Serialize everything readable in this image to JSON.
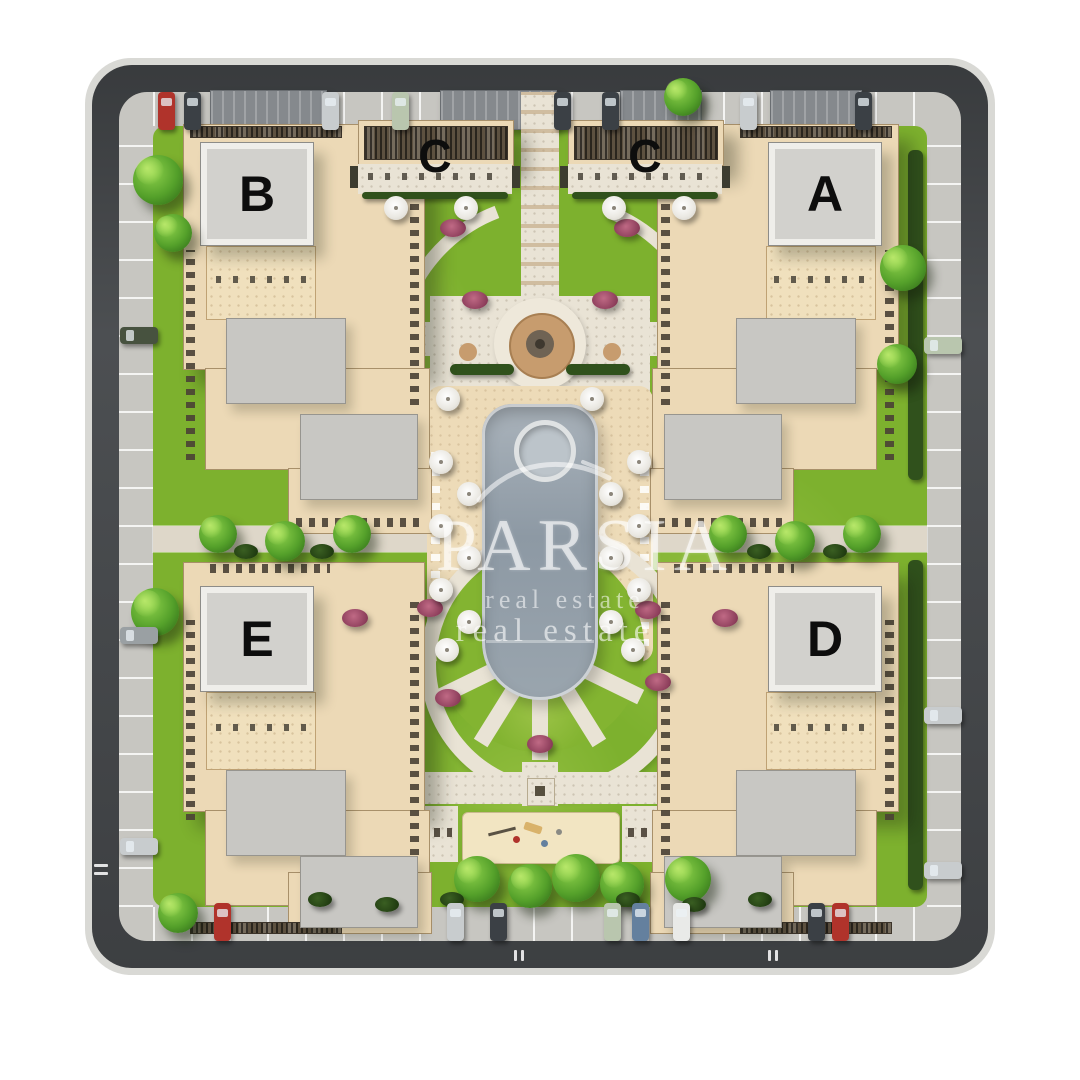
{
  "site": {
    "type": "residential-complex-site-plan",
    "buildings": [
      {
        "id": "building-b",
        "label": "B"
      },
      {
        "id": "building-c-left",
        "label": "C"
      },
      {
        "id": "building-c-right",
        "label": "C"
      },
      {
        "id": "building-a",
        "label": "A"
      },
      {
        "id": "building-e",
        "label": "E"
      },
      {
        "id": "building-d",
        "label": "D"
      }
    ]
  },
  "watermark": {
    "brand": "PARSIA",
    "subtitle_line1": "real estate",
    "subtitle_line2": "real estate"
  },
  "colors": {
    "lawn": "#7db12e",
    "asphalt": "#45484b",
    "parking_strip": "#c7c6c1",
    "stone_path": "#e9e3d5",
    "deck": "#eddbb8",
    "building_beige": "#ecd9b6",
    "roof_gray": "#d2d1cd",
    "pool_water": "#96a2ac",
    "umbrella": "#f2f0ea",
    "fountain_tan": "#c79c6e",
    "tree_green": "#54a02a",
    "flower": "#8e3f5c",
    "car_red": "#b0332b",
    "car_silver": "#c8ccce",
    "car_dark": "#3b4045",
    "car_blue": "#64809e",
    "car_palegreen": "#b9c6ae",
    "car_darkgreen": "#47523f",
    "car_gray": "#9aa0a3",
    "car_white": "#e9eae8"
  }
}
